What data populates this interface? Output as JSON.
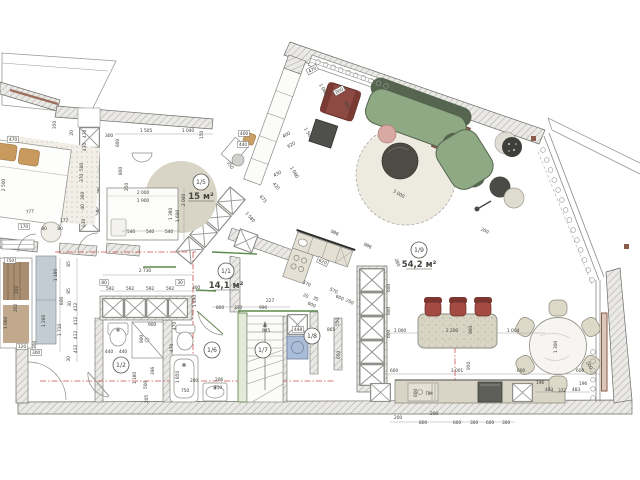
{
  "plan": {
    "type": "apartment floor plan",
    "units": "mm",
    "accent_colors": {
      "wall_hatch": "#a8a8a5",
      "section_line_red": "#cc4f48",
      "lintel_green": "#5a8a4a",
      "sofa_green": "#8fa985",
      "chair_maroon": "#8c4a42",
      "washer_blue": "#a9bdd9",
      "radiator_brown": "#8a5a4a"
    }
  },
  "rooms": [
    {
      "id": "1/1",
      "area": "14,1 м²",
      "x": 226,
      "y": 271
    },
    {
      "id": "1/2",
      "area": "",
      "x": 121,
      "y": 365
    },
    {
      "id": "1/5",
      "area": "15 м²",
      "x": 201,
      "y": 182
    },
    {
      "id": "1/6",
      "area": "",
      "x": 212,
      "y": 350
    },
    {
      "id": "1/7",
      "area": "",
      "x": 263,
      "y": 350
    },
    {
      "id": "1/8",
      "area": "",
      "x": 312,
      "y": 336
    },
    {
      "id": "1/9",
      "area": "54,2 м²",
      "x": 419,
      "y": 250
    }
  ],
  "dims": [
    {
      "t": "470",
      "x": 13,
      "y": 141,
      "b": 1
    },
    {
      "t": "777",
      "x": 30,
      "y": 213,
      "r": -8
    },
    {
      "t": "2 500",
      "x": 5,
      "y": 185,
      "r": -90
    },
    {
      "t": "170",
      "x": 24,
      "y": 228,
      "b": 1
    },
    {
      "t": "80",
      "x": 44,
      "y": 230
    },
    {
      "t": "80",
      "x": 60,
      "y": 230
    },
    {
      "t": "177",
      "x": 64,
      "y": 222
    },
    {
      "t": "750",
      "x": 10,
      "y": 262,
      "b": 1
    },
    {
      "t": "202",
      "x": 18,
      "y": 290,
      "r": -90
    },
    {
      "t": "202",
      "x": 17,
      "y": 308,
      "r": -90
    },
    {
      "t": "800",
      "x": 63,
      "y": 301,
      "r": -90
    },
    {
      "t": "1 060",
      "x": 7,
      "y": 323,
      "r": -90
    },
    {
      "t": "1 260",
      "x": 45,
      "y": 321,
      "r": -90
    },
    {
      "t": "300",
      "x": 36,
      "y": 345,
      "r": -90
    },
    {
      "t": "120",
      "x": 22,
      "y": 348,
      "b": 1
    },
    {
      "t": "300",
      "x": 36,
      "y": 354,
      "b": 1
    },
    {
      "t": "1 180",
      "x": 57,
      "y": 275,
      "r": -90
    },
    {
      "t": "85",
      "x": 70,
      "y": 264,
      "r": -90
    },
    {
      "t": "85",
      "x": 70,
      "y": 291,
      "r": -90
    },
    {
      "t": "30",
      "x": 71,
      "y": 304,
      "r": -90
    },
    {
      "t": "1 710",
      "x": 61,
      "y": 330,
      "r": -90
    },
    {
      "t": "412",
      "x": 77,
      "y": 307,
      "r": -90
    },
    {
      "t": "412",
      "x": 77,
      "y": 321,
      "r": -90
    },
    {
      "t": "412",
      "x": 77,
      "y": 335,
      "r": -90
    },
    {
      "t": "412",
      "x": 77,
      "y": 349,
      "r": -90
    },
    {
      "t": "30",
      "x": 70,
      "y": 359,
      "r": -90
    },
    {
      "t": "350",
      "x": 56,
      "y": 125,
      "r": -90
    },
    {
      "t": "20",
      "x": 73,
      "y": 133,
      "r": -90
    },
    {
      "t": "470",
      "x": 86,
      "y": 134,
      "r": -90
    },
    {
      "t": "430",
      "x": 86,
      "y": 147,
      "r": -90
    },
    {
      "t": "500",
      "x": 83,
      "y": 167,
      "r": -90
    },
    {
      "t": "370",
      "x": 83,
      "y": 178,
      "r": -90
    },
    {
      "t": "360",
      "x": 84,
      "y": 196,
      "r": -90
    },
    {
      "t": "40",
      "x": 84,
      "y": 207,
      "r": -90
    },
    {
      "t": "630",
      "x": 85,
      "y": 223,
      "r": -90
    },
    {
      "t": "300",
      "x": 109,
      "y": 137
    },
    {
      "t": "600",
      "x": 119,
      "y": 143,
      "r": -90
    },
    {
      "t": "1 505",
      "x": 146,
      "y": 132
    },
    {
      "t": "1 040",
      "x": 188,
      "y": 132
    },
    {
      "t": "150",
      "x": 203,
      "y": 135,
      "r": -90
    },
    {
      "t": "800",
      "x": 122,
      "y": 171,
      "r": -90
    },
    {
      "t": "250",
      "x": 128,
      "y": 187,
      "r": -90
    },
    {
      "t": "2 000",
      "x": 143,
      "y": 194
    },
    {
      "t": "1 900",
      "x": 143,
      "y": 202
    },
    {
      "t": "2 000",
      "x": 185,
      "y": 200,
      "r": -90
    },
    {
      "t": "1 380",
      "x": 172,
      "y": 214,
      "r": -90
    },
    {
      "t": "1 600",
      "x": 179,
      "y": 216,
      "r": -90
    },
    {
      "t": "540",
      "x": 131,
      "y": 233
    },
    {
      "t": "540",
      "x": 150,
      "y": 233
    },
    {
      "t": "540",
      "x": 169,
      "y": 233
    },
    {
      "t": "400",
      "x": 244,
      "y": 135,
      "b": 1
    },
    {
      "t": "440",
      "x": 243,
      "y": 146,
      "b": 1
    },
    {
      "t": "350",
      "x": 229,
      "y": 166,
      "r": 55
    },
    {
      "t": "1 580",
      "x": 249,
      "y": 218,
      "r": 50
    },
    {
      "t": "675",
      "x": 262,
      "y": 200,
      "r": 50
    },
    {
      "t": "420",
      "x": 275,
      "y": 187,
      "r": 50
    },
    {
      "t": "470",
      "x": 313,
      "y": 71,
      "r": -30,
      "b": 1
    },
    {
      "t": "1 080",
      "x": 322,
      "y": 90,
      "r": 60
    },
    {
      "t": "800",
      "x": 340,
      "y": 92,
      "r": -30,
      "b": 1
    },
    {
      "t": "850",
      "x": 346,
      "y": 106,
      "r": 60
    },
    {
      "t": "400",
      "x": 287,
      "y": 136,
      "r": -30
    },
    {
      "t": "620",
      "x": 292,
      "y": 146,
      "r": -30
    },
    {
      "t": "1 500",
      "x": 307,
      "y": 134,
      "r": 60
    },
    {
      "t": "430",
      "x": 278,
      "y": 175,
      "r": -30
    },
    {
      "t": "1 080",
      "x": 293,
      "y": 173,
      "r": 60
    },
    {
      "t": "3 000",
      "x": 398,
      "y": 195,
      "r": 30
    },
    {
      "t": "986",
      "x": 334,
      "y": 234,
      "r": 25
    },
    {
      "t": "986",
      "x": 367,
      "y": 247,
      "r": 25
    },
    {
      "t": "200",
      "x": 484,
      "y": 232,
      "r": 25
    },
    {
      "t": "280",
      "x": 396,
      "y": 263,
      "r": 70
    },
    {
      "t": "620",
      "x": 322,
      "y": 263,
      "r": 25,
      "b": 1
    },
    {
      "t": "570",
      "x": 306,
      "y": 285,
      "r": 25
    },
    {
      "t": "20",
      "x": 305,
      "y": 297,
      "r": 25
    },
    {
      "t": "35",
      "x": 315,
      "y": 300,
      "r": 25
    },
    {
      "t": "600",
      "x": 311,
      "y": 306,
      "r": 25
    },
    {
      "t": "570",
      "x": 333,
      "y": 292,
      "r": 25
    },
    {
      "t": "600",
      "x": 339,
      "y": 299,
      "r": 25
    },
    {
      "t": "250",
      "x": 349,
      "y": 303,
      "r": 25
    },
    {
      "t": "600",
      "x": 390,
      "y": 288,
      "r": -90
    },
    {
      "t": "600",
      "x": 390,
      "y": 311,
      "r": -90
    },
    {
      "t": "600",
      "x": 390,
      "y": 334,
      "r": -90
    },
    {
      "t": "1 000",
      "x": 400,
      "y": 332
    },
    {
      "t": "2 200",
      "x": 452,
      "y": 332
    },
    {
      "t": "900",
      "x": 472,
      "y": 330,
      "r": -90
    },
    {
      "t": "1 004",
      "x": 513,
      "y": 332
    },
    {
      "t": "950",
      "x": 470,
      "y": 366,
      "r": -90
    },
    {
      "t": "600",
      "x": 394,
      "y": 372
    },
    {
      "t": "3 001",
      "x": 457,
      "y": 372
    },
    {
      "t": "600",
      "x": 580,
      "y": 372
    },
    {
      "t": "600",
      "x": 417,
      "y": 393,
      "r": -90
    },
    {
      "t": "ПМ",
      "x": 429,
      "y": 395
    },
    {
      "t": "200",
      "x": 398,
      "y": 419
    },
    {
      "t": "200",
      "x": 434,
      "y": 415
    },
    {
      "t": "800",
      "x": 423,
      "y": 424
    },
    {
      "t": "600",
      "x": 457,
      "y": 424
    },
    {
      "t": "300",
      "x": 474,
      "y": 424
    },
    {
      "t": "600",
      "x": 490,
      "y": 424
    },
    {
      "t": "300",
      "x": 506,
      "y": 424
    },
    {
      "t": "1 300",
      "x": 557,
      "y": 347,
      "r": -90
    },
    {
      "t": "600",
      "x": 521,
      "y": 372
    },
    {
      "t": "196",
      "x": 540,
      "y": 384
    },
    {
      "t": "483",
      "x": 549,
      "y": 391
    },
    {
      "t": "372",
      "x": 562,
      "y": 392
    },
    {
      "t": "483",
      "x": 576,
      "y": 391
    },
    {
      "t": "196",
      "x": 583,
      "y": 385
    },
    {
      "t": "200",
      "x": 588,
      "y": 366,
      "r": 60
    },
    {
      "t": "2 730",
      "x": 145,
      "y": 272
    },
    {
      "t": "80",
      "x": 104,
      "y": 284,
      "b": 1
    },
    {
      "t": "592",
      "x": 110,
      "y": 290
    },
    {
      "t": "592",
      "x": 130,
      "y": 290
    },
    {
      "t": "592",
      "x": 150,
      "y": 290
    },
    {
      "t": "592",
      "x": 170,
      "y": 290
    },
    {
      "t": "30",
      "x": 180,
      "y": 284,
      "b": 1
    },
    {
      "t": "300",
      "x": 196,
      "y": 289
    },
    {
      "t": "440",
      "x": 109,
      "y": 353
    },
    {
      "t": "440",
      "x": 123,
      "y": 353
    },
    {
      "t": "900",
      "x": 143,
      "y": 339,
      "r": -90
    },
    {
      "t": "900",
      "x": 152,
      "y": 326
    },
    {
      "t": "53",
      "x": 124,
      "y": 364,
      "r": -90
    },
    {
      "t": "1 180",
      "x": 136,
      "y": 378,
      "r": -90
    },
    {
      "t": "500",
      "x": 147,
      "y": 385,
      "r": -90
    },
    {
      "t": "396",
      "x": 154,
      "y": 371,
      "r": -90
    },
    {
      "t": "205",
      "x": 148,
      "y": 399,
      "r": -90
    },
    {
      "t": "470",
      "x": 176,
      "y": 326,
      "r": -90
    },
    {
      "t": "470",
      "x": 173,
      "y": 348,
      "r": -90
    },
    {
      "t": "1 850",
      "x": 179,
      "y": 377,
      "r": -90
    },
    {
      "t": "750",
      "x": 185,
      "y": 392
    },
    {
      "t": "200",
      "x": 194,
      "y": 382
    },
    {
      "t": "206",
      "x": 219,
      "y": 381
    },
    {
      "t": "710",
      "x": 218,
      "y": 389
    },
    {
      "t": "1 490",
      "x": 196,
      "y": 301,
      "r": -90
    },
    {
      "t": "227",
      "x": 270,
      "y": 302
    },
    {
      "t": "800",
      "x": 220,
      "y": 309
    },
    {
      "t": "310",
      "x": 238,
      "y": 309
    },
    {
      "t": "990",
      "x": 263,
      "y": 309
    },
    {
      "t": "945",
      "x": 266,
      "y": 332
    },
    {
      "t": "865",
      "x": 331,
      "y": 331
    },
    {
      "t": "448",
      "x": 298,
      "y": 331,
      "b": 1
    },
    {
      "t": "550",
      "x": 339,
      "y": 322,
      "r": -90
    },
    {
      "t": "650",
      "x": 340,
      "y": 355,
      "r": -90
    }
  ]
}
